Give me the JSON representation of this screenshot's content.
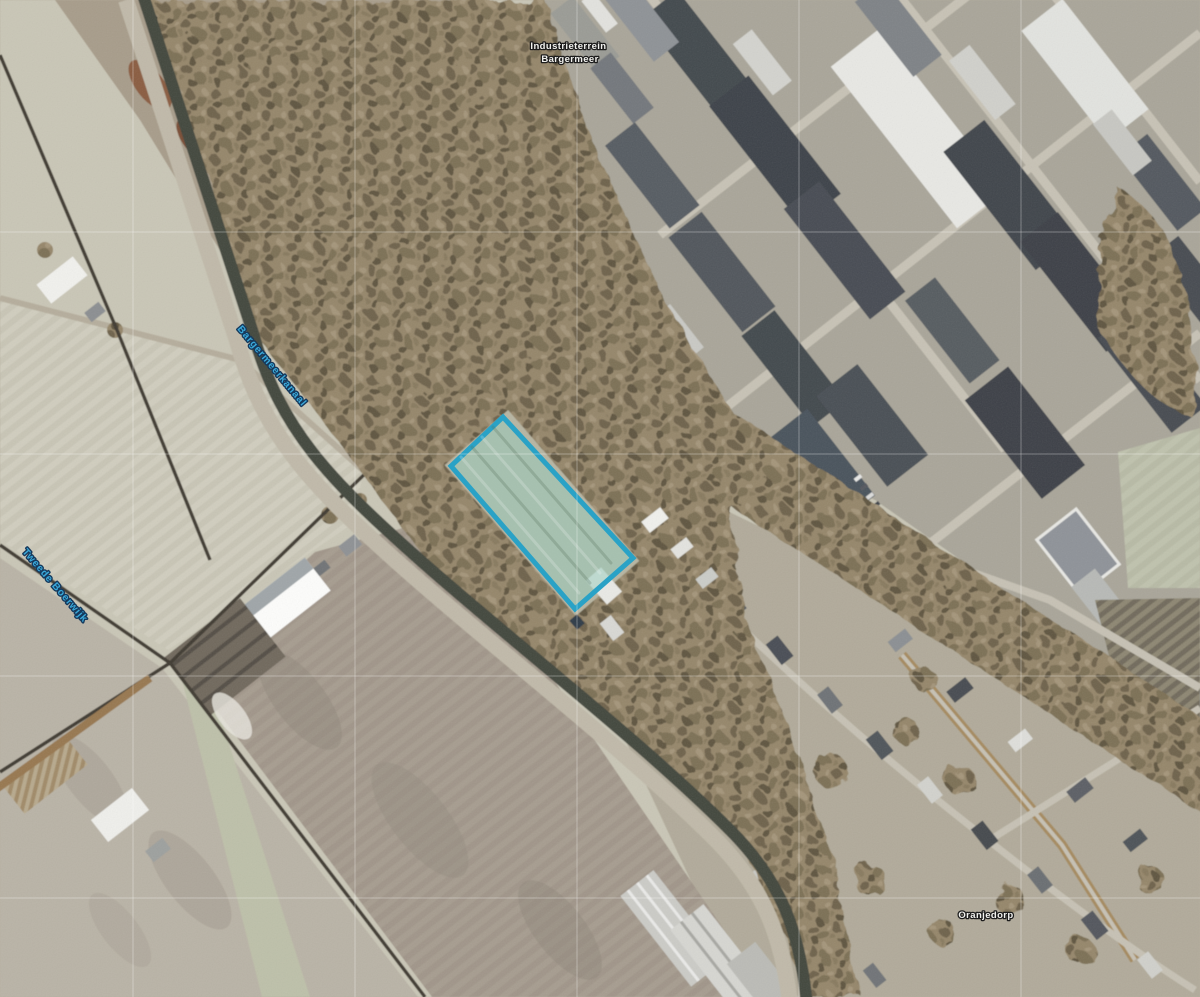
{
  "map": {
    "view_type": "aerial-photo-with-cadastral-overlay",
    "labels": {
      "industrial_area": {
        "line1": "Industrieterrein",
        "line2": "Bargermeer"
      },
      "canal": "Bargermeerkanaal",
      "waterway": "Tweede Boerwijk",
      "village": "Oranjedorp"
    },
    "label_styles": {
      "place_color": "#f2f2ef",
      "place_outline": "#1c1c1c",
      "water_color": "#3aa9da",
      "water_outline": "#16395c"
    },
    "highlight_parcel": {
      "stroke_color": "#2aa2c6",
      "fill_color": "rgba(150,203,188,0.5)",
      "stroke_width": "5"
    },
    "grid": {
      "line_color": "rgba(255,255,255,0.32)"
    }
  }
}
